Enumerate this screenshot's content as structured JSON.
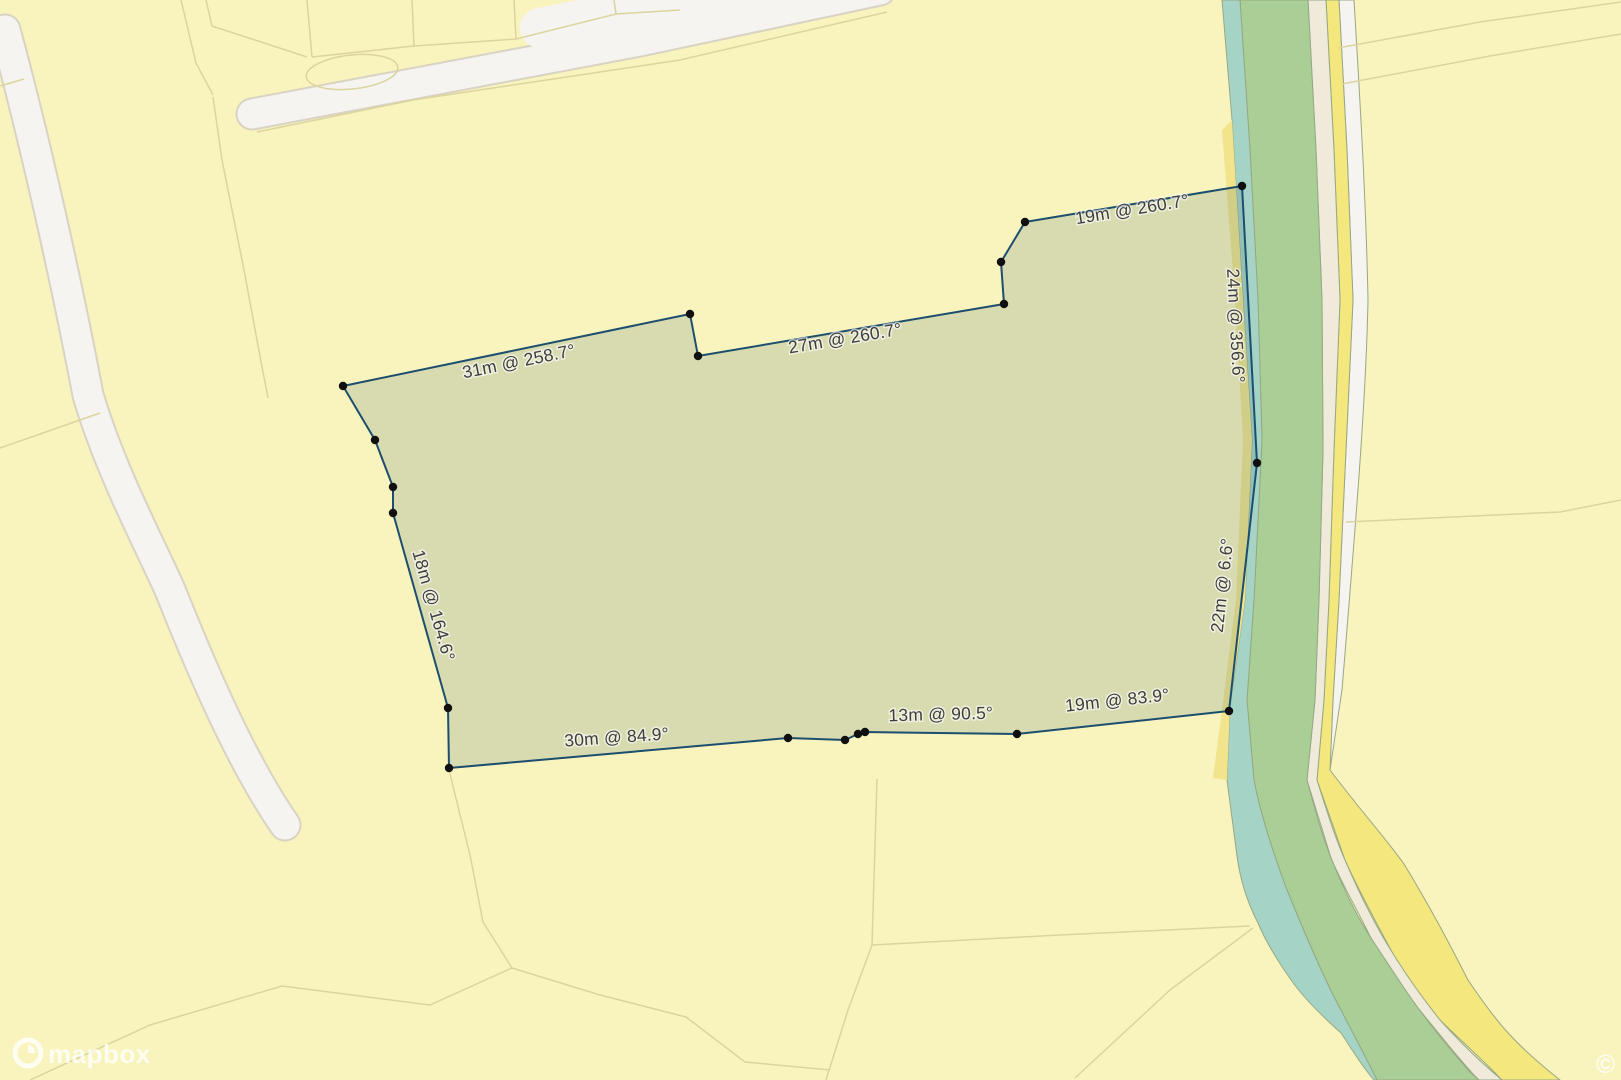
{
  "map": {
    "logo_text": "mapbox",
    "attribution": "©"
  },
  "palette": {
    "base_yellow": "#F9F3BD",
    "parcel_line": "#DCD49E",
    "road_fill": "#F5F4F0",
    "road_casing": "#D8D3C3",
    "green_band": "#A9CE96",
    "teal_band": "#A5D4C6",
    "cream_band": "#EFEADA",
    "bright_yellow_band": "#F4E77E",
    "bank_yellow_band": "#F1E48C",
    "band_outline": "#97A883",
    "plot_fill": "rgba(28,78,110,0.15)",
    "plot_stroke": "#1C4E6E",
    "vertex_dot": "#101010",
    "label_text": "#3E3E3E",
    "logo_white": "rgba(255,255,255,0.78)"
  },
  "measurements": {
    "edges": [
      {
        "text": "31m @ 258.7°",
        "distance_m": 31,
        "bearing_deg": 258.7
      },
      {
        "text": "27m @ 260.7°",
        "distance_m": 27,
        "bearing_deg": 260.7
      },
      {
        "text": "19m @ 260.7°",
        "distance_m": 19,
        "bearing_deg": 260.7
      },
      {
        "text": "24m @ 356.6°",
        "distance_m": 24,
        "bearing_deg": 356.6
      },
      {
        "text": "22m @ 6.6°",
        "distance_m": 22,
        "bearing_deg": 6.6
      },
      {
        "text": "18m @ 164.6°",
        "distance_m": 18,
        "bearing_deg": 164.6
      },
      {
        "text": "30m @ 84.9°",
        "distance_m": 30,
        "bearing_deg": 84.9
      },
      {
        "text": "13m @ 90.5°",
        "distance_m": 13,
        "bearing_deg": 90.5
      },
      {
        "text": "19m @ 83.9°",
        "distance_m": 19,
        "bearing_deg": 83.9
      }
    ]
  }
}
